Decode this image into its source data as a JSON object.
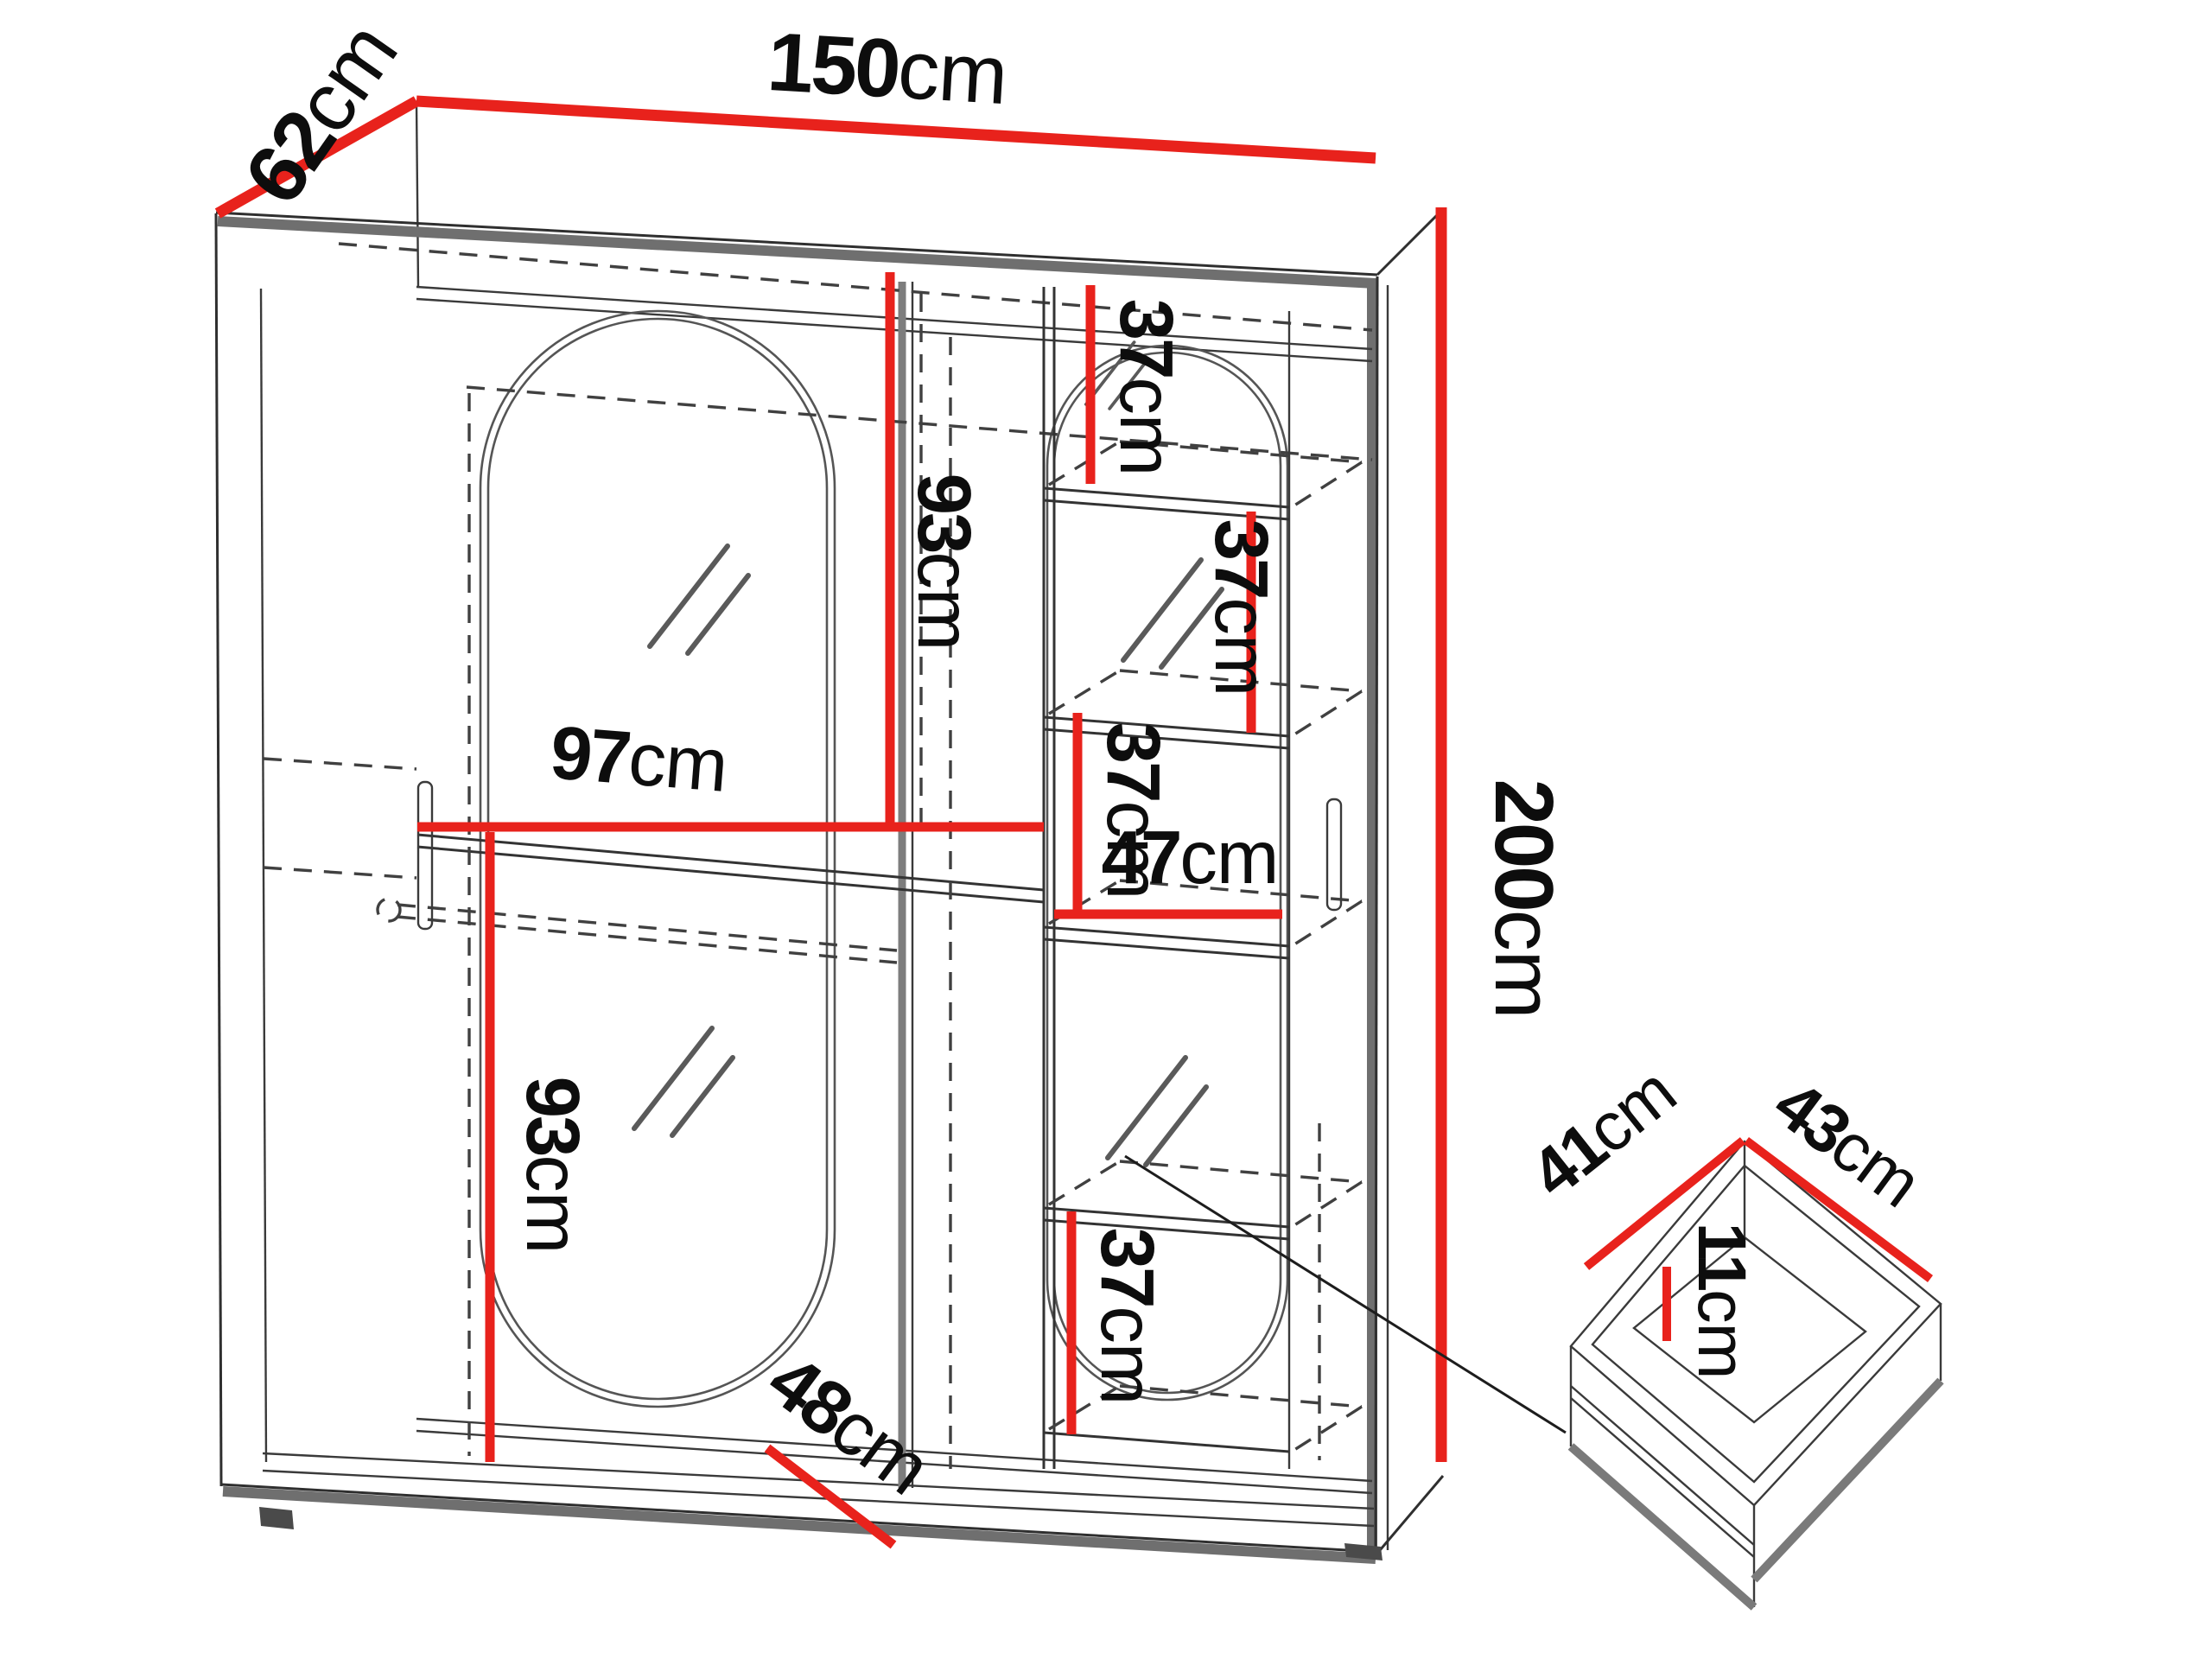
{
  "title": "Sliding wardrobe dimension diagram with drawer detail",
  "unit": "cm",
  "colors": {
    "dimension_line": "#e8221c",
    "outline": "#2f2f2f",
    "panel_gray": "#6f6f6f",
    "background": "#ffffff"
  },
  "labels": {
    "width": {
      "value": "150",
      "unit": "cm"
    },
    "depth": {
      "value": "62",
      "unit": "cm"
    },
    "height": {
      "value": "200",
      "unit": "cm"
    },
    "left_section_width": {
      "value": "97",
      "unit": "cm"
    },
    "mirror_upper": {
      "value": "93",
      "unit": "cm"
    },
    "mirror_lower": {
      "value": "93",
      "unit": "cm"
    },
    "shelf_gap_top": {
      "value": "37",
      "unit": "cm"
    },
    "shelf_gap_inner": {
      "value": "37",
      "unit": "cm"
    },
    "shelf_gap_middle": {
      "value": "37",
      "unit": "cm"
    },
    "shelf_gap_bottom": {
      "value": "37",
      "unit": "cm"
    },
    "column_width": {
      "value": "47",
      "unit": "cm"
    },
    "base_diagonal": {
      "value": "48",
      "unit": "cm"
    },
    "drawer_depth": {
      "value": "41",
      "unit": "cm"
    },
    "drawer_width": {
      "value": "43",
      "unit": "cm"
    },
    "drawer_height": {
      "value": "11",
      "unit": "cm"
    }
  }
}
